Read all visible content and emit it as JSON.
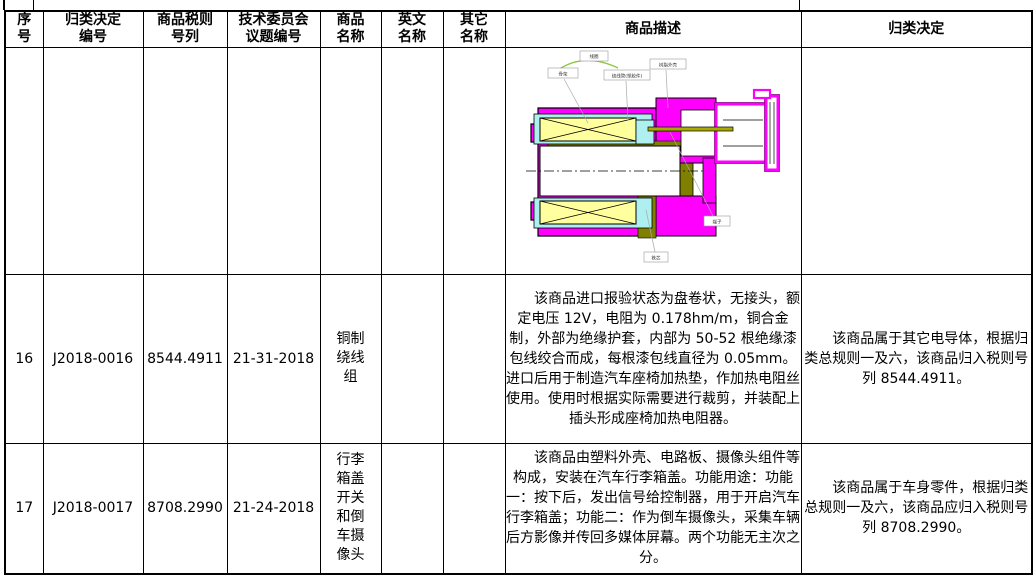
{
  "table": {
    "headers": [
      "序\n号",
      "归类决定\n编号",
      "商品税则\n号列",
      "技术委员会\n议题编号",
      "商品\n名称",
      "英文\n名称",
      "其它\n名称",
      "商品描述",
      "归类决定"
    ],
    "rows": [
      {
        "seq": "",
        "decision_no": "",
        "tariff_no": "",
        "committee_no": "",
        "name": "",
        "en_name": "",
        "other_name": "",
        "decision": ""
      },
      {
        "seq": "16",
        "decision_no": "J2018-0016",
        "tariff_no": "8544.4911",
        "committee_no": "21-31-2018",
        "name": "铜制绕线组",
        "en_name": "",
        "other_name": "",
        "description": "该商品进口报验状态为盘卷状，无接头，额定电压 12V，电阻为 0.178hm/m，铜合金制，外部为绝缘护套，内部为 50-52 根绝缘漆包线绞合而成，每根漆包线直径为 0.05mm。进口后用于制造汽车座椅加热垫，作加热电阻丝使用。使用时根据实际需要进行裁剪，并装配上插头形成座椅加热电阻器。",
        "decision": "该商品属于其它电导体，根据归类总规则一及六，该商品归入税则号列 8544.4911。"
      },
      {
        "seq": "17",
        "decision_no": "J2018-0017",
        "tariff_no": "8708.2990",
        "committee_no": "21-24-2018",
        "name": "行李箱盖开关和倒车摄像头",
        "en_name": "",
        "other_name": "",
        "description": "该商品由塑料外壳、电路板、摄像头组件等构成，安装在汽车行李箱盖。功能用途：功能一：按下后，发出信号给控制器，用于开启汽车行李箱盖；功能二：作为倒车摄像头，采集车辆后方影像并传回多媒体屏幕。两个功能无主次之分。",
        "decision": "该商品属于车身零件，根据归类总规则一及六，该商品应归入税则号列 8708.2990。"
      }
    ],
    "diagram_labels": {
      "coil": "线圈",
      "bobbin": "骨架",
      "winding_tube": "绕线管(塑胶件)",
      "resin_shell": "树脂外壳",
      "terminal": "端子",
      "core": "铁芯"
    },
    "diagram_colors": {
      "body": "#ff00ff",
      "coil_fill": "#ffff9e",
      "bobbin_fill": "#aeefef",
      "core_fill": "#808000",
      "arc": "#8cc63f"
    }
  }
}
